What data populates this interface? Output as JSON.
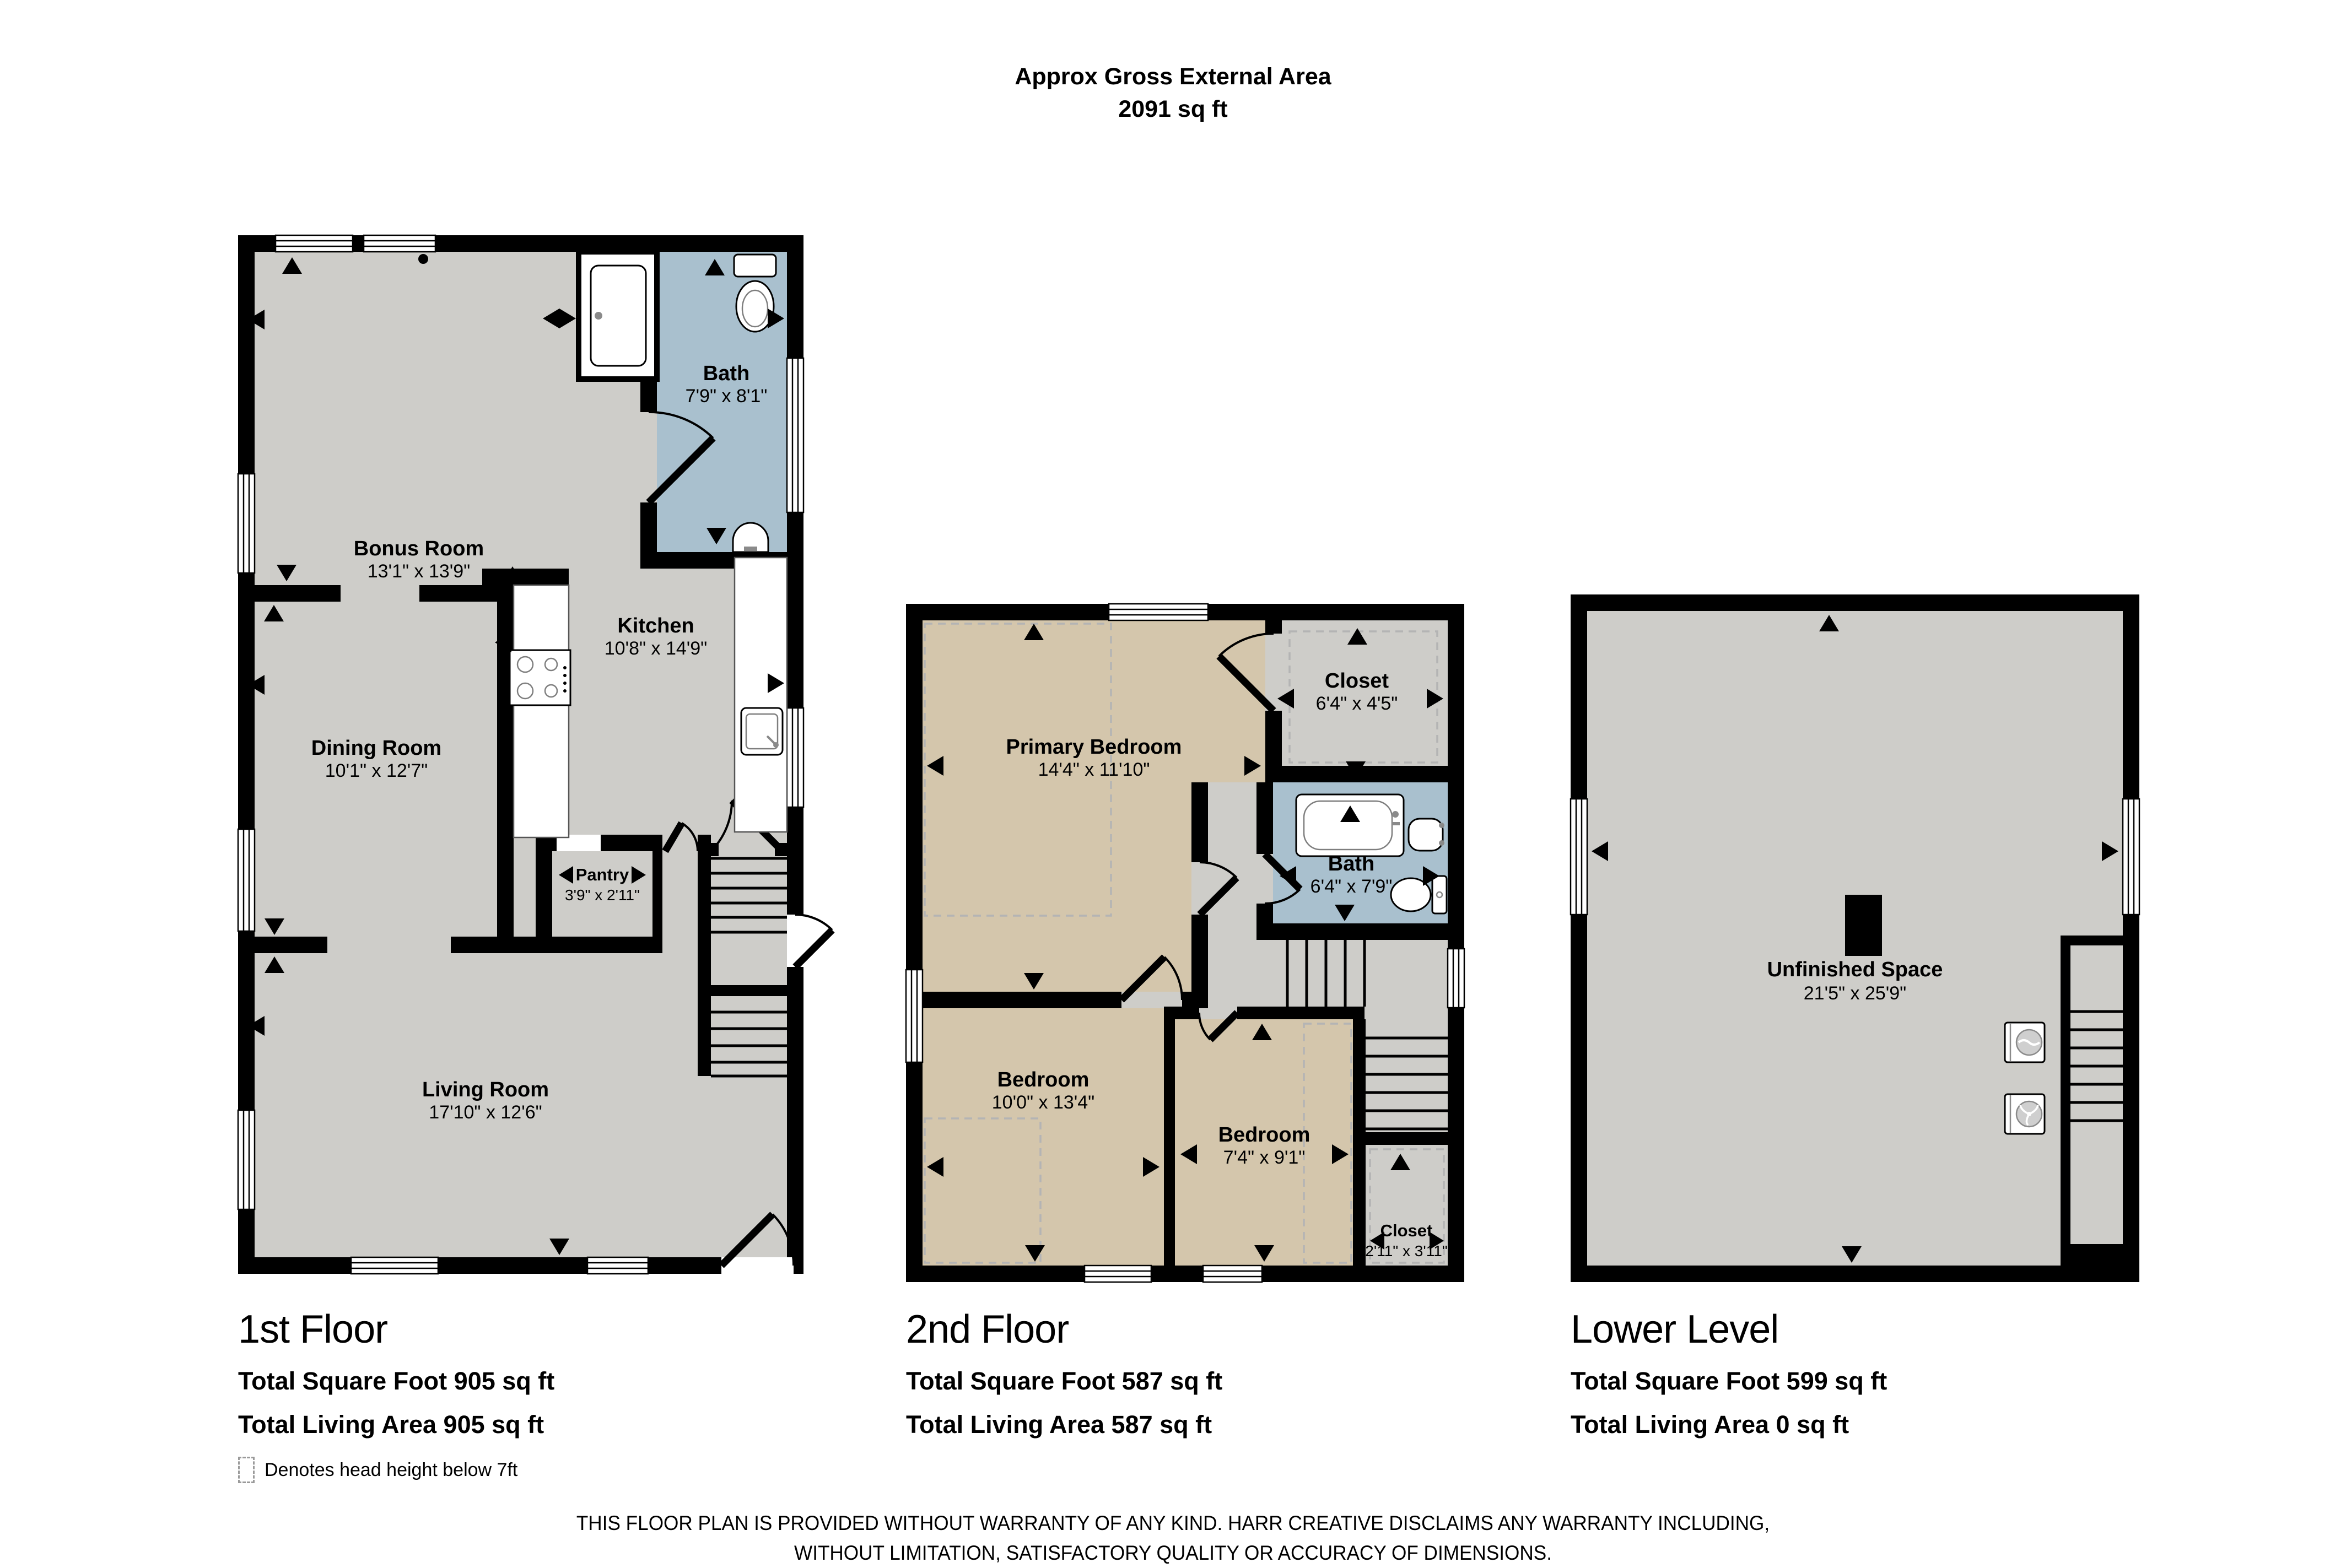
{
  "header": {
    "title_line1": "Approx Gross External Area",
    "title_line2": "2091 sq ft"
  },
  "colors": {
    "wall": "#000000",
    "floor_gray": "#cecdc9",
    "bedroom_tan": "#d4c6ac",
    "bath_blue": "#a9c0ce",
    "dashed_gray": "#b4b4b4"
  },
  "floors": [
    {
      "title": "1st Floor",
      "sqft_line": "Total Square Foot 905 sq ft",
      "living_line": "Total Living Area 905 sq ft",
      "rooms": [
        {
          "name": "Bonus Room",
          "dims": "13'1\" x 13'9\""
        },
        {
          "name": "Bath",
          "dims": "7'9\" x 8'1\""
        },
        {
          "name": "Kitchen",
          "dims": "10'8\" x 14'9\""
        },
        {
          "name": "Dining Room",
          "dims": "10'1\" x 12'7\""
        },
        {
          "name": "Pantry",
          "dims": "3'9\" x 2'11\""
        },
        {
          "name": "Living Room",
          "dims": "17'10\" x 12'6\""
        }
      ]
    },
    {
      "title": "2nd Floor",
      "sqft_line": "Total Square Foot 587 sq ft",
      "living_line": "Total Living Area 587 sq ft",
      "rooms": [
        {
          "name": "Primary Bedroom",
          "dims": "14'4\" x 11'10\""
        },
        {
          "name": "Closet",
          "dims": "6'4\" x 4'5\""
        },
        {
          "name": "Bath",
          "dims": "6'4\" x 7'9\""
        },
        {
          "name": "Bedroom",
          "dims": "10'0\" x 13'4\""
        },
        {
          "name": "Bedroom",
          "dims": "7'4\" x 9'1\""
        },
        {
          "name": "Closet",
          "dims": "2'11\" x 3'11\""
        }
      ]
    },
    {
      "title": "Lower Level",
      "sqft_line": "Total Square Foot 599 sq ft",
      "living_line": "Total Living Area 0 sq ft",
      "rooms": [
        {
          "name": "Unfinished Space",
          "dims": "21'5\" x 25'9\""
        }
      ]
    }
  ],
  "legend": {
    "text": "Denotes head height below 7ft"
  },
  "disclaimer": {
    "line1": "THIS FLOOR PLAN IS PROVIDED WITHOUT WARRANTY OF ANY KIND. HARR CREATIVE DISCLAIMS ANY WARRANTY INCLUDING,",
    "line2": "WITHOUT LIMITATION, SATISFACTORY QUALITY OR ACCURACY OF DIMENSIONS."
  }
}
